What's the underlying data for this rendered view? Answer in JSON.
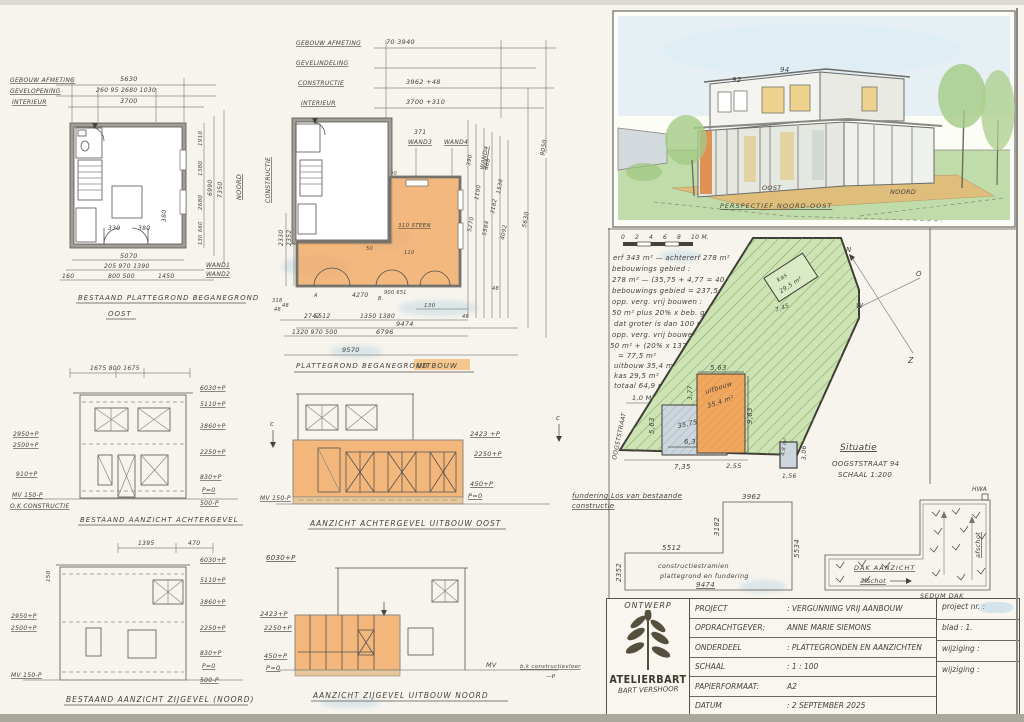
{
  "colors": {
    "orange": "#f2a75f",
    "green": "#b4d395",
    "ink": "#45423c"
  },
  "planA": {
    "rows": [
      {
        "label": "GEBOUW AFMETING",
        "value": "5630"
      },
      {
        "label": "GEVELOPENING",
        "value": "260  95  2680  1030"
      },
      {
        "label": "INTERIEUR",
        "value": "3700"
      }
    ],
    "right_inner": [
      "1910",
      "1380",
      "2680",
      "660",
      "130"
    ],
    "right_mid": "6990",
    "right_outer": "7350",
    "compass": "NOORD",
    "bottom1": "5070",
    "bottom2": "205  970  1390",
    "bottom3a": "160",
    "bottom3b": "800  500",
    "bottom3c": "1450",
    "inner1": "330",
    "inner2": "380",
    "inner3": "380",
    "wand1": "WAND1",
    "wand2": "WAND2",
    "title": "BESTAAND PLATTEGROND BEGANEGROND",
    "subtitle": "OOST"
  },
  "planB": {
    "rows": [
      {
        "label": "GEBOUW AFMETING",
        "value": "70      3940"
      },
      {
        "label": "GEVELINDELING",
        "value": ""
      },
      {
        "label": "CONSTRUCTIE",
        "value": "3962        +48"
      },
      {
        "label": "INTERIEUR",
        "value": "3700        +310"
      }
    ],
    "dim371": "371",
    "wand3": "WAND3",
    "wand4": "WAND4",
    "wand4b": "WAND4",
    "d90": "90",
    "left_vert": "CONSTRUCTIE",
    "left1": "2330",
    "left2": "2352",
    "left3": "318",
    "left4": "48",
    "stone": "310 STEEN",
    "d50": "50",
    "d110": "110",
    "r5270": "5270",
    "r5584": "5584",
    "r3182": "3182",
    "r4092": "4092",
    "r1538": "1538",
    "r1190": "1190",
    "r390": "390",
    "r468": "468",
    "r5630": "5630",
    "r9050": "9050",
    "r48": "48",
    "b130": "130",
    "b48a": "48",
    "b5512": "5512",
    "b2742": "2742",
    "b1350": "1350  1380",
    "b48b": "48",
    "b9474": "9474",
    "b1320": "1320  970  500",
    "b6796": "6796",
    "b9570": "9570",
    "b4270": "4270",
    "b900": "900  651",
    "mA": "A",
    "mB": "B.",
    "title": "PLATTEGROND BEGANEGROND",
    "title_hl": "UITBOUW"
  },
  "perspective": {
    "num_left": "92",
    "num_right": "94",
    "ground_left": "OOST",
    "ground_right": "NOORD",
    "caption": "PERSPECTIEF NOORD-OOST"
  },
  "site": {
    "scale_labels": [
      "0",
      "2",
      "4",
      "6",
      "8",
      "10 M."
    ],
    "calc": [
      "erf 343 m²  —  achtererf 278 m²",
      "bebouwings gebied :",
      "278 m² — (35,75 + 4,77 = 40,5)",
      "bebouwings gebied = 237,5 m²",
      "opp. verg. vrij bouwen :",
      "50 m²  plus 20% x beb. gebied",
      "dat groter is dan 100 m².",
      "opp. verg. vrij bouwen is :",
      "50 m² + (20% x 137,5 = 27,5)",
      "=  77,5 m²",
      "uitbouw    35,4 m²",
      "kas          29,5 m²",
      "totaal      64,9 m²"
    ],
    "one_m": "1,0 M.",
    "kas1": "kas",
    "kas2": "29,5 m²",
    "d745": "7,45",
    "uit1": "uitbouw",
    "uit2": "35,4 m²",
    "d563t": "5,63",
    "d377": "3,77",
    "d963": "9,63",
    "d563l": "5,63",
    "house_area": "35,75 m²",
    "d635": "6,35",
    "d735": "7,35",
    "d255": "2,55",
    "shed": "4,8 m²",
    "d306": "3,06",
    "d156": "1,56",
    "street": "OOGSTSTRAAT",
    "n": "N",
    "o": "O",
    "w": "W",
    "z": "Z",
    "cap1": "Situatie",
    "cap2": "OOGSTSTRAAT 94",
    "cap3": "SCHAAL 1:200"
  },
  "elevA": {
    "top_dim": "1675     800     1675",
    "left": [
      "2950+P",
      "2500+P",
      "910+P",
      "MV 150-P",
      "O.K CONSTRUCTIE"
    ],
    "right": [
      "6030+P",
      "5110+P",
      "3860+P",
      "2250+P",
      "830+P",
      "P=0",
      "500-P"
    ],
    "title": "BESTAAND AANZICHT ACHTERGEVEL"
  },
  "elevB": {
    "right": [
      "2423 +P",
      "2250+P",
      "450+P",
      "P=0"
    ],
    "left_mv": "MV 150-P",
    "c": "c",
    "title": "AANZICHT ACHTERGEVEL UITBOUW OOST"
  },
  "elevC": {
    "top1": "1395",
    "top2": "470",
    "v150": "150",
    "left": [
      "2950+P",
      "2500+P",
      "MV 150-P"
    ],
    "right": [
      "6030+P",
      "5110+P",
      "3860+P",
      "2250+P",
      "830+P",
      "P=0",
      "500-P"
    ],
    "title": "BESTAAND AANZICHT ZIJGEVEL (NOORD)"
  },
  "elevD": {
    "left": [
      "6030+P",
      "2423+P",
      "2250+P",
      "450+P",
      "P=0"
    ],
    "mv": "MV",
    "note": "b.k constructievloer",
    "note2": "—P",
    "title": "AANZICHT ZIJGEVEL UITBOUW NOORD"
  },
  "fundering": {
    "note1": "fundering Los van bestaande",
    "note2": "constructie",
    "d3962": "3962",
    "d3182": "3182",
    "d5534": "5534",
    "d5512": "5512",
    "d2352": "2352",
    "d9474": "9474",
    "inner1": "constructiestramien",
    "inner2": "plattegrond en fundering"
  },
  "dak": {
    "title": "DAK AANZICHT",
    "afschot1": "afschot",
    "afschot2": "afschot",
    "hwa": "HWA",
    "sedum": "SEDUM DAK"
  },
  "titleblock": {
    "ontwerp": "ONTWERP",
    "brand": "ATELIERBART",
    "brand_sub": "BART VERSHOOR",
    "rows": [
      {
        "label": "PROJECT",
        "value": ":  VERGUNNING VRIJ AANBOUW"
      },
      {
        "label": "OPDRACHTGEVER:",
        "value": "ANNE MARIE SIEMONS"
      },
      {
        "label": "ONDERDEEL",
        "value": ":  PLATTEGRONDEN EN AANZICHTEN"
      },
      {
        "label": "SCHAAL",
        "value": ":  1 : 100"
      },
      {
        "label": "PAPIERFORMAAT:",
        "value": "A2"
      },
      {
        "label": "DATUM",
        "value": ":  2 SEPTEMBER 2025"
      }
    ],
    "right": [
      "project nr. :",
      "blad : 1.",
      "wijziging :",
      "wijziging :"
    ]
  }
}
